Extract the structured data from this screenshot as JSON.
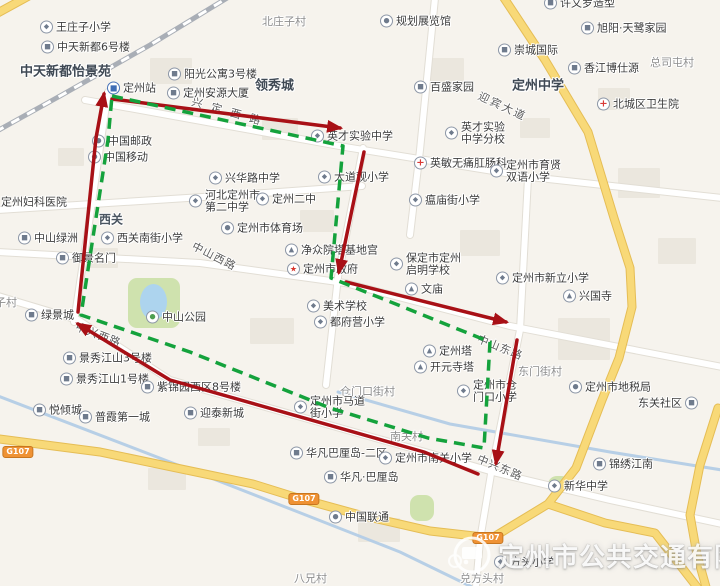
{
  "watermark": {
    "company": "定州市公共交通有限公司"
  },
  "colors": {
    "land": "#f6f3ed",
    "building": "#ebe7de",
    "park": "#cfe2ae",
    "water": "#b3cce6",
    "road_white": "#ffffff",
    "road_casing": "#e2ded5",
    "road_yellow": "#f8d978",
    "road_yellow_casing": "#e5bd55",
    "railway": "#a9aeb6",
    "route_red": "#a81016",
    "route_green": "#14a23c",
    "badge_orange": "#ef9234"
  },
  "icon_legend": {
    "school": "school-icon",
    "residence": "building-icon",
    "medical": "red-cross-icon",
    "government": "red-star-icon",
    "heritage": "pagoda-icon",
    "station": "train-station-icon",
    "place": "poi-dot-icon",
    "park": "tree-icon"
  },
  "routes": [
    {
      "name": "red-route",
      "color": "#a81016",
      "style": "solid",
      "width": 3.5,
      "arrows": true,
      "segments": [
        [
          [
            112,
            99
          ],
          [
            340,
            128
          ]
        ],
        [
          [
            364,
            152
          ],
          [
            339,
            272
          ]
        ],
        [
          [
            346,
            282
          ],
          [
            506,
            322
          ]
        ],
        [
          [
            517,
            340
          ],
          [
            496,
            463
          ]
        ],
        [
          [
            478,
            474
          ],
          [
            424,
            452
          ],
          [
            170,
            380
          ],
          [
            78,
            324
          ]
        ],
        [
          [
            78,
            312
          ],
          [
            96,
            138
          ],
          [
            104,
            94
          ]
        ]
      ]
    },
    {
      "name": "green-route",
      "color": "#14a23c",
      "style": "dashed",
      "width": 3.5,
      "arrows": false,
      "segments": [
        [
          [
            112,
            96
          ],
          [
            343,
            146
          ],
          [
            331,
            278
          ],
          [
            490,
            342
          ],
          [
            484,
            448
          ],
          [
            428,
            438
          ],
          [
            330,
            408
          ],
          [
            190,
            352
          ],
          [
            81,
            315
          ],
          [
            108,
            140
          ],
          [
            112,
            96
          ]
        ]
      ]
    }
  ],
  "road_labels": [
    {
      "text": "兴定西路",
      "x": 192,
      "y": 101,
      "angle": 16,
      "ls": 9
    },
    {
      "text": "迎宾大道",
      "x": 479,
      "y": 95,
      "angle": 25,
      "ls": 2
    },
    {
      "text": "中山西路",
      "x": 193,
      "y": 245,
      "angle": 27,
      "ls": 1
    },
    {
      "text": "中山东路",
      "x": 478,
      "y": 338,
      "angle": 22,
      "ls": 1
    },
    {
      "text": "中兴西路",
      "x": 76,
      "y": 326,
      "angle": 21,
      "ls": 1
    },
    {
      "text": "中兴东路",
      "x": 478,
      "y": 458,
      "angle": 23,
      "ls": 1
    }
  ],
  "area_labels": [
    {
      "text": "中天新都怡景苑",
      "x": 20,
      "y": 70,
      "kind": "district"
    },
    {
      "text": "领秀城",
      "x": 255,
      "y": 84,
      "kind": "district"
    },
    {
      "text": "定州中学",
      "x": 512,
      "y": 84,
      "kind": "district"
    },
    {
      "text": "西关",
      "x": 99,
      "y": 219,
      "kind": "district-sm"
    },
    {
      "text": "北庄子村",
      "x": 262,
      "y": 21,
      "kind": "village"
    },
    {
      "text": "总司屯村",
      "x": 650,
      "y": 62,
      "kind": "village"
    },
    {
      "text": "庄子村",
      "x": -16,
      "y": 302,
      "kind": "village"
    },
    {
      "text": "东门街村",
      "x": 518,
      "y": 371,
      "kind": "village"
    },
    {
      "text": "仓门口街村",
      "x": 340,
      "y": 391,
      "kind": "village"
    },
    {
      "text": "南关村",
      "x": 390,
      "y": 436,
      "kind": "village"
    },
    {
      "text": "八兄村",
      "x": 294,
      "y": 578,
      "kind": "village"
    },
    {
      "text": "兑方头村",
      "x": 460,
      "y": 578,
      "kind": "village"
    }
  ],
  "badges": [
    {
      "text": "G107",
      "x": 18,
      "y": 452
    },
    {
      "text": "G107",
      "x": 304,
      "y": 499
    },
    {
      "text": "G107",
      "x": 488,
      "y": 538
    }
  ],
  "pois": [
    {
      "name": "王庄子小学",
      "x": 47,
      "y": 27,
      "icon": "school"
    },
    {
      "name": "中天新都6号楼",
      "x": 48,
      "y": 47,
      "icon": "residence"
    },
    {
      "name": "阳光公寓3号楼",
      "x": 175,
      "y": 74,
      "icon": "residence"
    },
    {
      "name": "定州安源大厦",
      "x": 174,
      "y": 93,
      "icon": "residence"
    },
    {
      "name": "定州站",
      "x": 114,
      "y": 88,
      "icon": "station"
    },
    {
      "name": "中国邮政",
      "x": 99,
      "y": 141,
      "icon": "place"
    },
    {
      "name": "中国移动",
      "x": 95,
      "y": 157,
      "icon": "place"
    },
    {
      "name": "规划展览馆",
      "x": 387,
      "y": 21,
      "icon": "place"
    },
    {
      "name": "百盛家园",
      "x": 421,
      "y": 87,
      "icon": "residence"
    },
    {
      "name": "英才实验中学",
      "x": 318,
      "y": 136,
      "icon": "school"
    },
    {
      "name": "英才实验中学分校",
      "lines": [
        "英才实验",
        "中学分校"
      ],
      "x": 452,
      "y": 133,
      "icon": "school"
    },
    {
      "name": "许文罗造型",
      "x": 551,
      "y": 3,
      "icon": "residence"
    },
    {
      "name": "旭阳·天鹭家园",
      "x": 588,
      "y": 28,
      "icon": "residence"
    },
    {
      "name": "崇城国际",
      "x": 505,
      "y": 50,
      "icon": "residence"
    },
    {
      "name": "香江博仕源",
      "x": 575,
      "y": 68,
      "icon": "residence"
    },
    {
      "name": "北城区卫生院",
      "x": 604,
      "y": 104,
      "icon": "medical"
    },
    {
      "name": "兴华路中学",
      "x": 216,
      "y": 178,
      "icon": "school"
    },
    {
      "name": "大道观小学",
      "x": 325,
      "y": 177,
      "icon": "school"
    },
    {
      "name": "河北定州市第二中学",
      "lines": [
        "河北定州市",
        "第二中学"
      ],
      "x": 196,
      "y": 201,
      "icon": "school"
    },
    {
      "name": "定州二中",
      "x": 263,
      "y": 199,
      "icon": "school"
    },
    {
      "name": "定州市体育场",
      "x": 228,
      "y": 228,
      "icon": "place"
    },
    {
      "name": "定州妇科医院",
      "x": -8,
      "y": 202,
      "icon": "medical"
    },
    {
      "name": "中山绿洲",
      "x": 25,
      "y": 238,
      "icon": "residence"
    },
    {
      "name": "西关南街小学",
      "x": 108,
      "y": 238,
      "icon": "school"
    },
    {
      "name": "御景名门",
      "x": 63,
      "y": 258,
      "icon": "residence"
    },
    {
      "name": "净众院塔基地宫",
      "x": 292,
      "y": 250,
      "icon": "heritage"
    },
    {
      "name": "定州市政府",
      "x": 294,
      "y": 269,
      "icon": "government"
    },
    {
      "name": "保定市定州启明学校",
      "lines": [
        "保定市定州",
        "启明学校"
      ],
      "x": 397,
      "y": 264,
      "icon": "school"
    },
    {
      "name": "文庙",
      "x": 412,
      "y": 289,
      "icon": "heritage"
    },
    {
      "name": "英敏无痛肛肠科",
      "x": 421,
      "y": 163,
      "icon": "medical"
    },
    {
      "name": "瘟庙街小学",
      "x": 416,
      "y": 200,
      "icon": "school"
    },
    {
      "name": "定州市育贤双语小学",
      "lines": [
        "定州市育贤",
        "双语小学"
      ],
      "x": 497,
      "y": 171,
      "icon": "school"
    },
    {
      "name": "定州市新立小学",
      "x": 503,
      "y": 278,
      "icon": "school"
    },
    {
      "name": "兴国寺",
      "x": 570,
      "y": 296,
      "icon": "heritage"
    },
    {
      "name": "美术学校",
      "x": 314,
      "y": 306,
      "icon": "school"
    },
    {
      "name": "都府营小学",
      "x": 321,
      "y": 322,
      "icon": "school"
    },
    {
      "name": "中山公园",
      "x": 153,
      "y": 317,
      "icon": "park"
    },
    {
      "name": "绿景城",
      "x": 32,
      "y": 315,
      "icon": "residence"
    },
    {
      "name": "景秀江山3号楼",
      "x": 70,
      "y": 358,
      "icon": "residence"
    },
    {
      "name": "景秀江山1号楼",
      "x": 67,
      "y": 379,
      "icon": "residence"
    },
    {
      "name": "紫锦园西区8号楼",
      "x": 148,
      "y": 387,
      "icon": "residence"
    },
    {
      "name": "悦倾城",
      "x": 40,
      "y": 410,
      "icon": "residence"
    },
    {
      "name": "普霞第一城",
      "x": 86,
      "y": 417,
      "icon": "residence"
    },
    {
      "name": "迎泰新城",
      "x": 191,
      "y": 413,
      "icon": "residence"
    },
    {
      "name": "定州塔",
      "x": 430,
      "y": 351,
      "icon": "heritage"
    },
    {
      "name": "开元寺塔",
      "x": 421,
      "y": 367,
      "icon": "heritage"
    },
    {
      "name": "定州市仓门口小学",
      "lines": [
        "定州市仓",
        "门口小学"
      ],
      "x": 464,
      "y": 391,
      "icon": "school"
    },
    {
      "name": "定州市地税局",
      "x": 576,
      "y": 387,
      "icon": "place"
    },
    {
      "name": "定州市马道街小学",
      "lines": [
        "定州市马道",
        "街小学"
      ],
      "x": 301,
      "y": 407,
      "icon": "school"
    },
    {
      "name": "华凡巴厘岛-二区",
      "x": 297,
      "y": 453,
      "icon": "residence"
    },
    {
      "name": "华凡·巴厘岛",
      "x": 331,
      "y": 477,
      "icon": "residence"
    },
    {
      "name": "定州市南关小学",
      "x": 386,
      "y": 458,
      "icon": "school"
    },
    {
      "name": "锦绣江南",
      "x": 600,
      "y": 464,
      "icon": "residence"
    },
    {
      "name": "新华中学",
      "x": 555,
      "y": 486,
      "icon": "school"
    },
    {
      "name": "东关社区",
      "x": 645,
      "y": 403,
      "icon": "residence",
      "iconSide": "right"
    },
    {
      "name": "中国联通",
      "x": 336,
      "y": 517,
      "icon": "place"
    },
    {
      "name": "方头小学",
      "x": 501,
      "y": 562,
      "icon": "school"
    }
  ],
  "basemap": {
    "railway": [
      [
        237,
        -8
      ],
      [
        150,
        45
      ],
      [
        60,
        96
      ],
      [
        -12,
        136
      ]
    ],
    "rivers": [
      [
        [
          -2,
          396
        ],
        [
          170,
          462
        ],
        [
          293,
          510
        ],
        [
          400,
          552
        ],
        [
          472,
          587
        ]
      ],
      [
        [
          338,
          392
        ],
        [
          450,
          424
        ],
        [
          610,
          452
        ],
        [
          722,
          470
        ]
      ]
    ],
    "roads_white": [
      [
        [
          85,
          100
        ],
        [
          345,
          147
        ],
        [
          530,
          177
        ],
        [
          722,
          198
        ]
      ],
      [
        [
          108,
          92
        ],
        [
          88,
          230
        ],
        [
          74,
          322
        ]
      ],
      [
        [
          -2,
          252
        ],
        [
          200,
          263
        ],
        [
          345,
          283
        ],
        [
          510,
          326
        ],
        [
          722,
          367
        ]
      ],
      [
        [
          -2,
          296
        ],
        [
          78,
          320
        ],
        [
          170,
          380
        ],
        [
          425,
          452
        ],
        [
          497,
          473
        ],
        [
          610,
          500
        ],
        [
          722,
          524
        ]
      ],
      [
        [
          363,
          148
        ],
        [
          338,
          277
        ],
        [
          326,
          385
        ]
      ],
      [
        [
          520,
          330
        ],
        [
          492,
          468
        ],
        [
          480,
          540
        ],
        [
          476,
          587
        ]
      ],
      [
        [
          -2,
          210
        ],
        [
          250,
          194
        ],
        [
          362,
          186
        ]
      ],
      [
        [
          435,
          -2
        ],
        [
          420,
          150
        ],
        [
          410,
          235
        ]
      ],
      [
        [
          528,
          178
        ],
        [
          520,
          330
        ]
      ]
    ],
    "roads_yellow": [
      [
        [
          500,
          -8
        ],
        [
          545,
          60
        ],
        [
          588,
          132
        ],
        [
          614,
          218
        ],
        [
          630,
          268
        ],
        [
          632,
          307
        ],
        [
          619,
          358
        ],
        [
          602,
          400
        ],
        [
          576,
          468
        ],
        [
          548,
          504
        ],
        [
          492,
          538
        ],
        [
          430,
          531
        ],
        [
          360,
          515
        ],
        [
          298,
          498
        ],
        [
          253,
          484
        ],
        [
          100,
          452
        ],
        [
          -8,
          438
        ]
      ],
      [
        [
          548,
          504
        ],
        [
          605,
          523
        ],
        [
          655,
          533
        ],
        [
          697,
          587
        ]
      ],
      [
        [
          718,
          408
        ],
        [
          700,
          465
        ],
        [
          690,
          515
        ],
        [
          697,
          555
        ],
        [
          706,
          587
        ]
      ],
      [
        [
          -4,
          14
        ],
        [
          36,
          -8
        ]
      ]
    ],
    "parks": [
      [
        128,
        278,
        52,
        50
      ],
      [
        410,
        495,
        24,
        26
      ],
      [
        548,
        476,
        22,
        17
      ]
    ],
    "lake": [
      140,
      284,
      27,
      36
    ],
    "buildings": [
      [
        150,
        58,
        42,
        26
      ],
      [
        262,
        118,
        36,
        22
      ],
      [
        88,
        248,
        30,
        20
      ],
      [
        430,
        58,
        34,
        24
      ],
      [
        618,
        168,
        42,
        30
      ],
      [
        250,
        318,
        44,
        26
      ],
      [
        558,
        318,
        52,
        42
      ],
      [
        148,
        468,
        38,
        22
      ],
      [
        520,
        118,
        30,
        20
      ],
      [
        58,
        148,
        26,
        18
      ],
      [
        358,
        518,
        42,
        24
      ],
      [
        598,
        88,
        32,
        22
      ],
      [
        198,
        428,
        32,
        18
      ],
      [
        658,
        238,
        38,
        26
      ],
      [
        300,
        210,
        34,
        22
      ],
      [
        460,
        230,
        40,
        26
      ]
    ]
  }
}
